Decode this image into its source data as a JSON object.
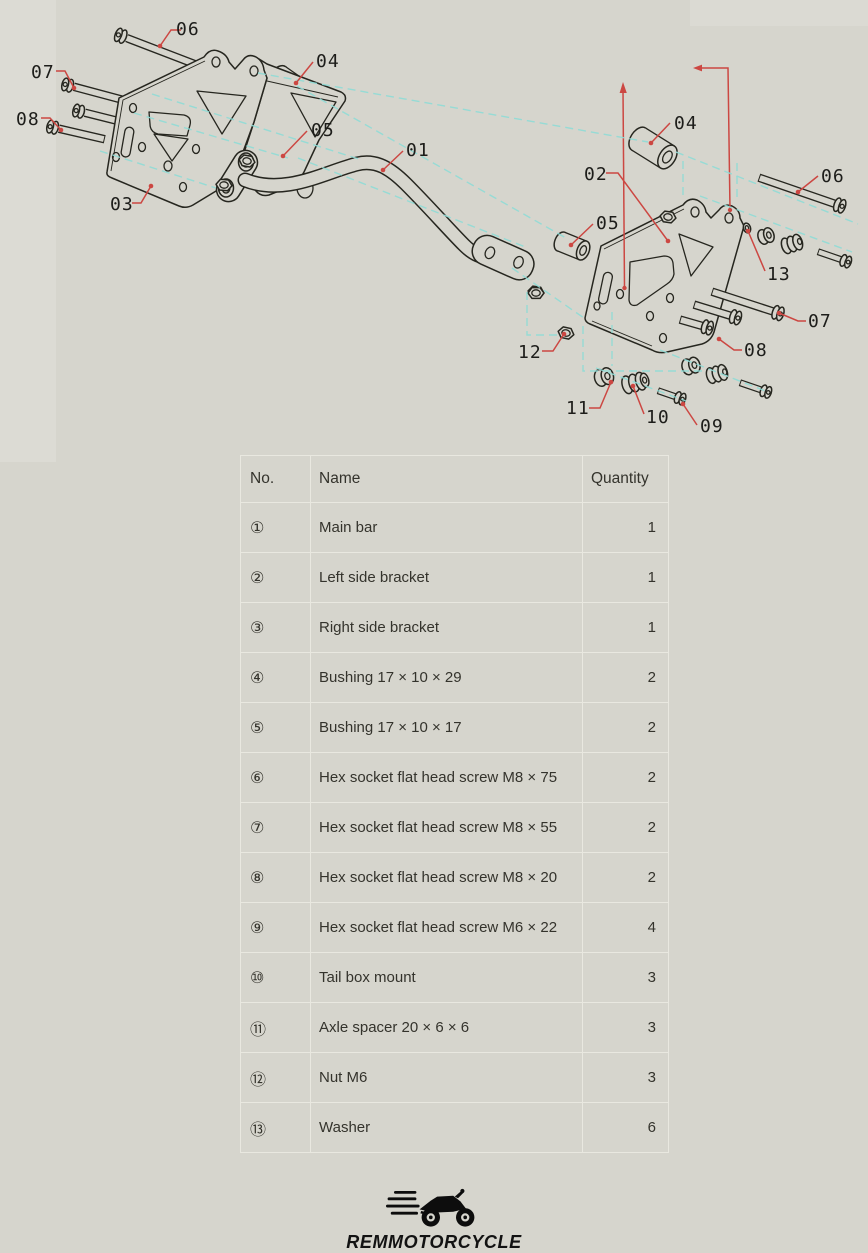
{
  "page": {
    "background": "#d6d5cd"
  },
  "diagram": {
    "stroke_color": "#26261f",
    "callout_color": "#cc4742",
    "construction_color": "#8fdcd6",
    "callouts": [
      {
        "label": "06",
        "tx": 176,
        "ty": 35,
        "pts": [
          [
            160,
            46
          ],
          [
            171,
            30
          ],
          [
            181,
            30
          ]
        ]
      },
      {
        "label": "07",
        "tx": 31,
        "ty": 78,
        "pts": [
          [
            74,
            88
          ],
          [
            65,
            71
          ],
          [
            56,
            71
          ]
        ]
      },
      {
        "label": "08",
        "tx": 16,
        "ty": 125,
        "pts": [
          [
            61,
            130
          ],
          [
            50,
            118
          ],
          [
            41,
            118
          ]
        ]
      },
      {
        "label": "03",
        "tx": 110,
        "ty": 210,
        "pts": [
          [
            151,
            186
          ],
          [
            141,
            203
          ],
          [
            132,
            203
          ]
        ]
      },
      {
        "label": "04",
        "tx": 316,
        "ty": 67,
        "pts": [
          [
            296,
            83
          ],
          [
            313,
            62
          ]
        ]
      },
      {
        "label": "05",
        "tx": 311,
        "ty": 136,
        "pts": [
          [
            283,
            156
          ],
          [
            307,
            131
          ]
        ]
      },
      {
        "label": "01",
        "tx": 406,
        "ty": 156,
        "pts": [
          [
            383,
            170
          ],
          [
            403,
            151
          ]
        ]
      },
      {
        "label": "04",
        "tx": 674,
        "ty": 129,
        "pts": [
          [
            651,
            143
          ],
          [
            670,
            123
          ]
        ]
      },
      {
        "label": "02",
        "tx": 584,
        "ty": 180,
        "pts": [
          [
            668,
            241
          ],
          [
            618,
            173
          ],
          [
            606,
            173
          ]
        ]
      },
      {
        "label": "05",
        "tx": 596,
        "ty": 229,
        "pts": [
          [
            571,
            245
          ],
          [
            593,
            224
          ]
        ]
      },
      {
        "label": "06",
        "tx": 821,
        "ty": 182,
        "pts": [
          [
            798,
            192
          ],
          [
            818,
            176
          ]
        ]
      },
      {
        "label": "13",
        "tx": 767,
        "ty": 280,
        "pts": [
          [
            748,
            231
          ],
          [
            765,
            271
          ]
        ]
      },
      {
        "label": "07",
        "tx": 808,
        "ty": 327,
        "pts": [
          [
            779,
            313
          ],
          [
            798,
            321
          ],
          [
            806,
            321
          ]
        ]
      },
      {
        "label": "08",
        "tx": 744,
        "ty": 356,
        "pts": [
          [
            719,
            339
          ],
          [
            734,
            350
          ],
          [
            742,
            350
          ]
        ]
      },
      {
        "label": "12",
        "tx": 518,
        "ty": 358,
        "pts": [
          [
            564,
            334
          ],
          [
            553,
            351
          ],
          [
            542,
            351
          ]
        ]
      },
      {
        "label": "11",
        "tx": 566,
        "ty": 414,
        "pts": [
          [
            611,
            382
          ],
          [
            600,
            408
          ],
          [
            589,
            408
          ]
        ]
      },
      {
        "label": "10",
        "tx": 646,
        "ty": 423,
        "pts": [
          [
            633,
            386
          ],
          [
            644,
            414
          ]
        ]
      },
      {
        "label": "09",
        "tx": 700,
        "ty": 432,
        "pts": [
          [
            683,
            404
          ],
          [
            697,
            425
          ]
        ]
      }
    ]
  },
  "table": {
    "headers": [
      "No.",
      "Name",
      "Quantity"
    ],
    "rows": [
      {
        "no": "①",
        "name": "Main bar",
        "qty": "1"
      },
      {
        "no": "②",
        "name": "Left side bracket",
        "qty": "1"
      },
      {
        "no": "③",
        "name": "Right side bracket",
        "qty": "1"
      },
      {
        "no": "④",
        "name": "Bushing 17 × 10 × 29",
        "qty": "2"
      },
      {
        "no": "⑤",
        "name": "Bushing 17 × 10 × 17",
        "qty": "2"
      },
      {
        "no": "⑥",
        "name": "Hex socket flat head screw M8 × 75",
        "qty": "2"
      },
      {
        "no": "⑦",
        "name": "Hex socket flat head screw M8 × 55",
        "qty": "2"
      },
      {
        "no": "⑧",
        "name": "Hex socket flat head screw M8 × 20",
        "qty": "2"
      },
      {
        "no": "⑨",
        "name": "Hex socket flat head screw M6 × 22",
        "qty": "4"
      },
      {
        "no": "⑩",
        "name": "Tail box mount",
        "qty": "3"
      },
      {
        "no": "⑪",
        "name": "Axle spacer 20 × 6 × 6",
        "qty": "3"
      },
      {
        "no": "⑫",
        "name": "Nut M6",
        "qty": "3"
      },
      {
        "no": "⑬",
        "name": "Washer",
        "qty": "6"
      }
    ]
  },
  "logo": {
    "brand": "REMMOTORCYCLE"
  }
}
